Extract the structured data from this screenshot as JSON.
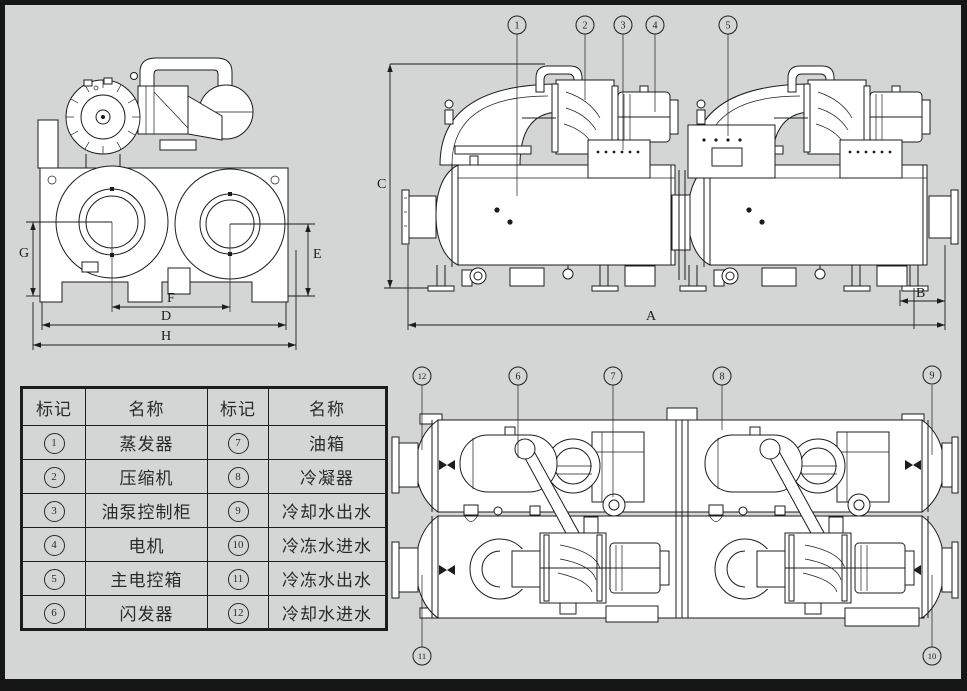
{
  "sheet": {
    "colors": {
      "background": "#d4d6d5",
      "line": "#1c1c1c",
      "paper": "#ffffff",
      "border": "#161616"
    }
  },
  "front_view": {
    "dims": {
      "g": "G",
      "e": "E",
      "f": "F",
      "d": "D",
      "h": "H"
    }
  },
  "side_view": {
    "dims": {
      "c": "C",
      "a": "A",
      "b": "B"
    },
    "callouts": [
      "1",
      "2",
      "3",
      "4",
      "5"
    ]
  },
  "plan_view": {
    "callouts_top": [
      "12",
      "6",
      "7",
      "8",
      "9"
    ],
    "callouts_bottom": [
      "11",
      "10"
    ]
  },
  "parts_table": {
    "headers": [
      "标记",
      "名称",
      "标记",
      "名称"
    ],
    "rows": [
      [
        "1",
        "蒸发器",
        "7",
        "油箱"
      ],
      [
        "2",
        "压缩机",
        "8",
        "冷凝器"
      ],
      [
        "3",
        "油泵控制柜",
        "9",
        "冷却水出水"
      ],
      [
        "4",
        "电机",
        "10",
        "冷冻水进水"
      ],
      [
        "5",
        "主电控箱",
        "11",
        "冷冻水出水"
      ],
      [
        "6",
        "闪发器",
        "12",
        "冷却水进水"
      ]
    ]
  }
}
